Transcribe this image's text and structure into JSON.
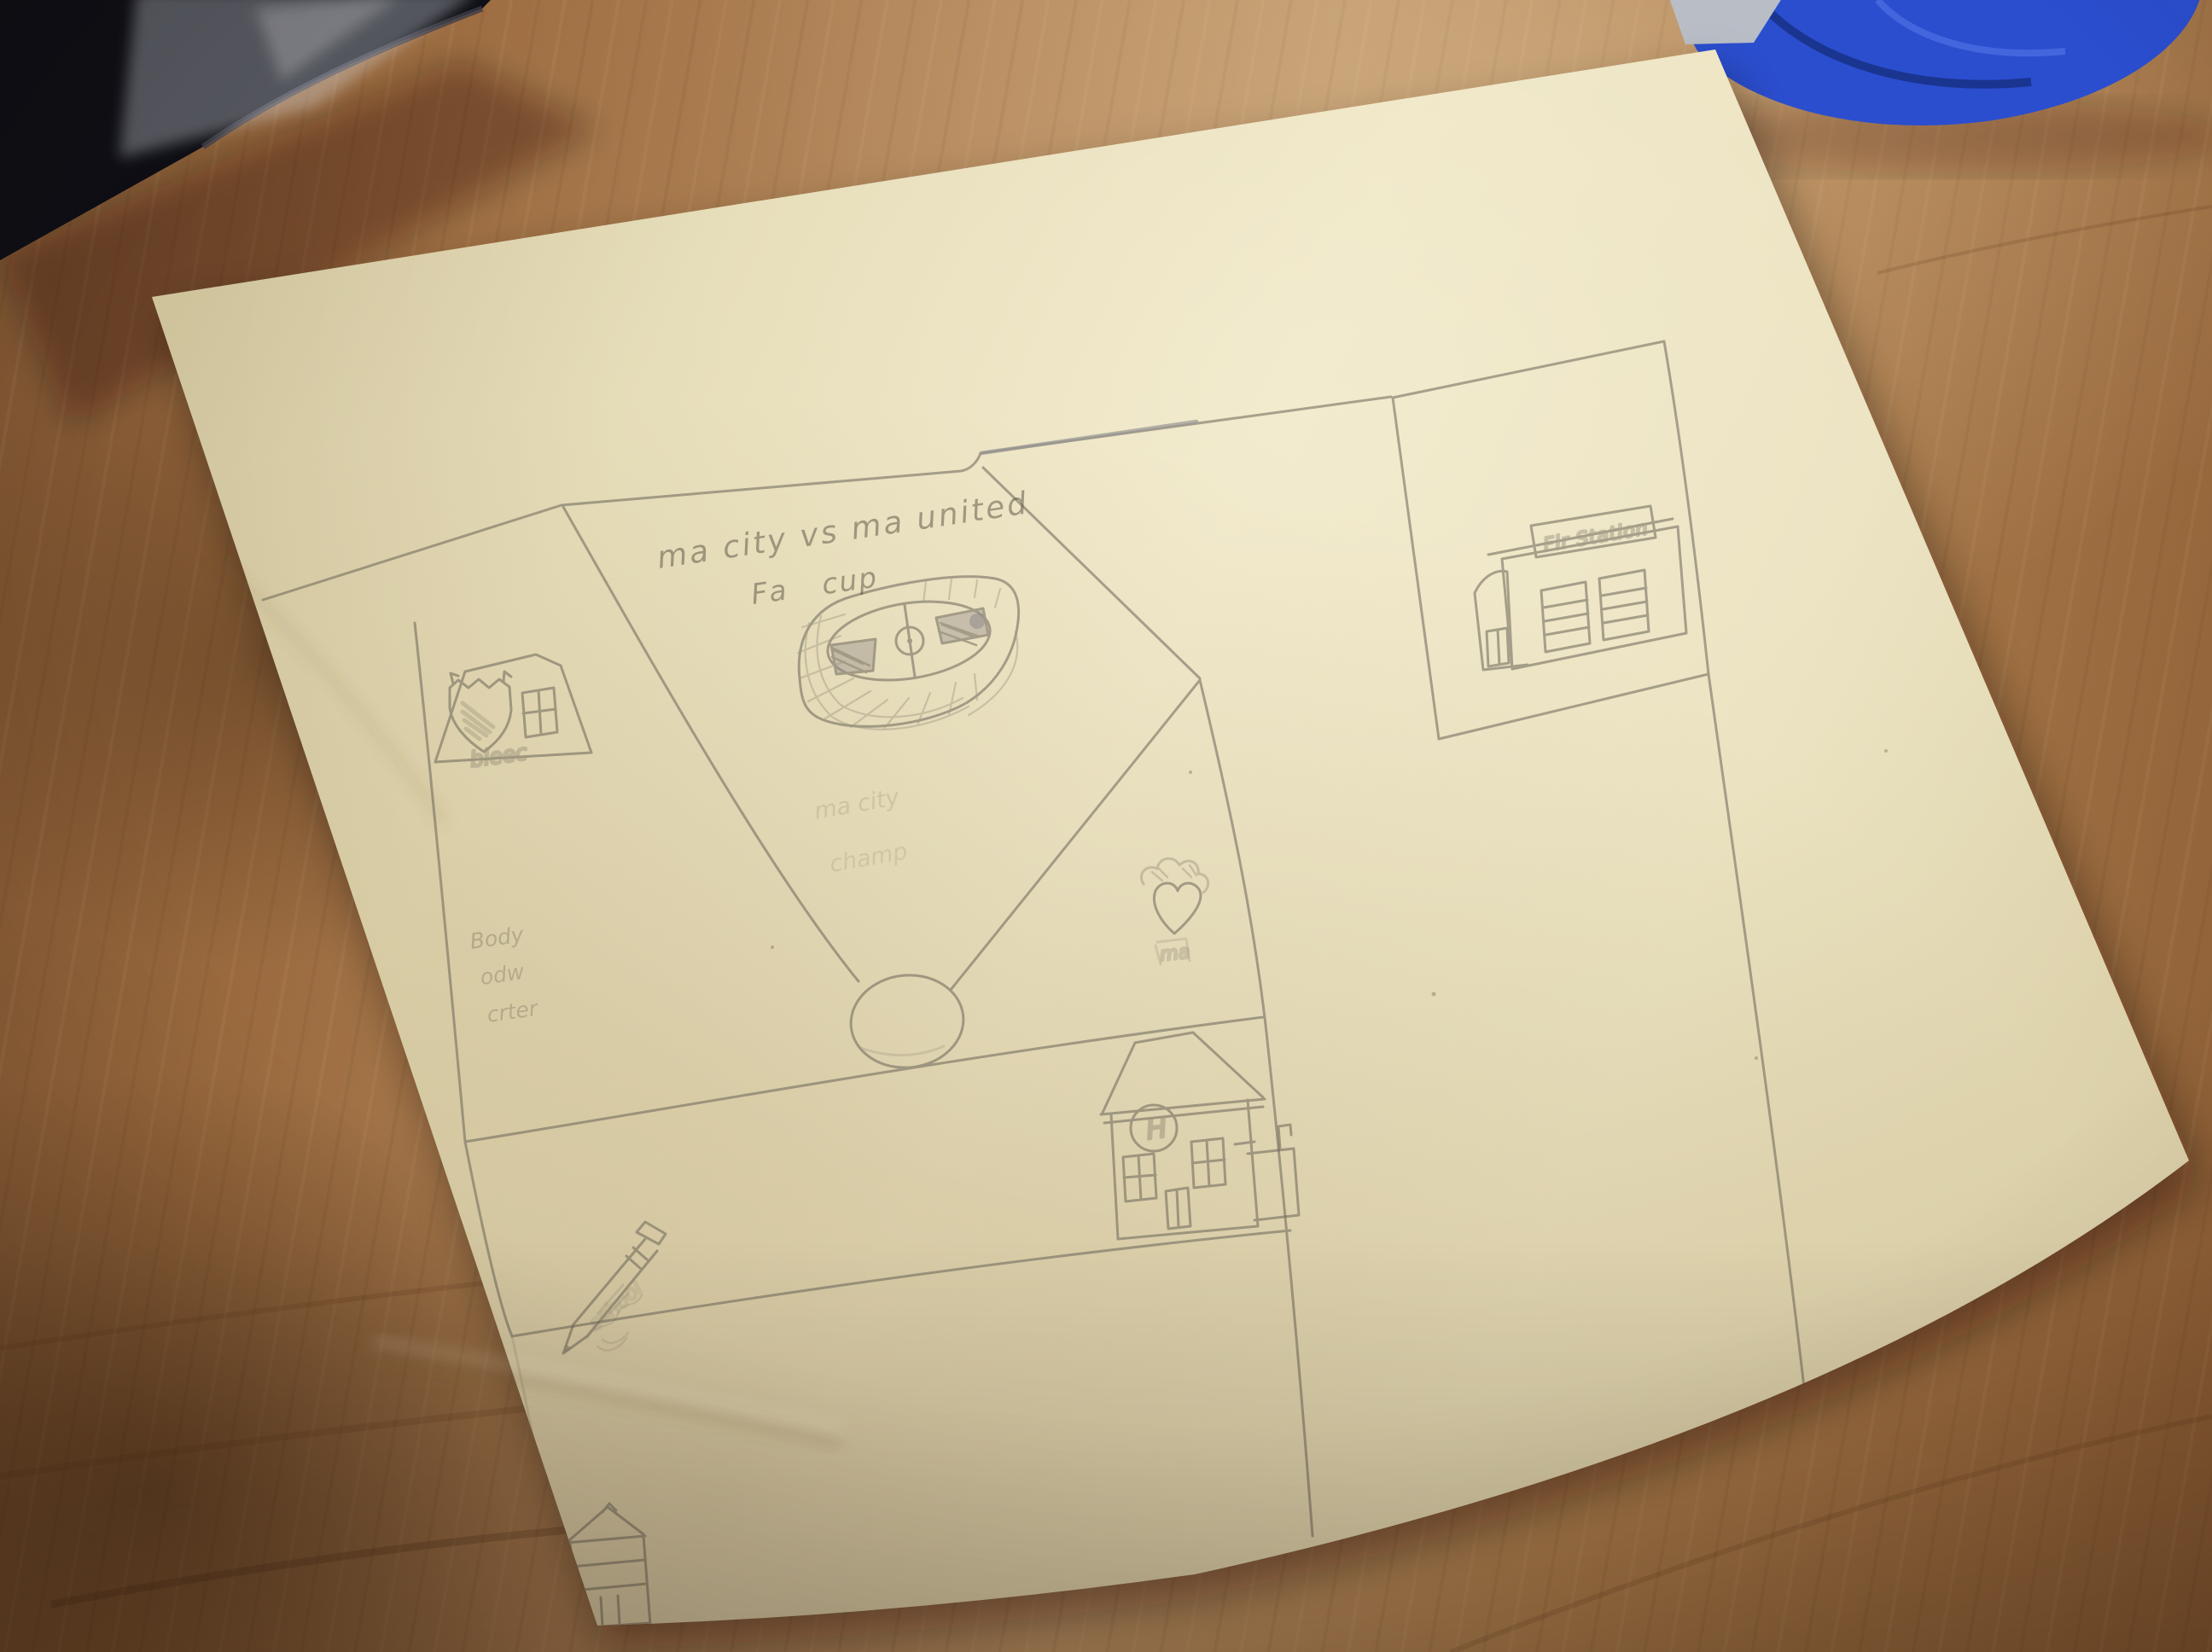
{
  "scene": {
    "kind": "photograph",
    "subject": "child's hand-drawn pencil town map (football match day) on cream paper lying on a wooden desk",
    "paper_color": "#ece3c0",
    "desk_color": "#a5743f",
    "pencil_color": "#6b6458"
  },
  "drawing": {
    "match_title": {
      "line1": "ma city vs ma united",
      "line2": "Fa cup"
    },
    "pub": {
      "sign": "bleec"
    },
    "fire_station": {
      "sign": "Fir Station"
    },
    "hospital": {
      "symbol": "H"
    },
    "notes": {
      "left": [
        "Body",
        "odw",
        "crter"
      ],
      "center": [
        "ma city",
        "champ"
      ],
      "heart": "ma",
      "pencil": "school"
    }
  }
}
